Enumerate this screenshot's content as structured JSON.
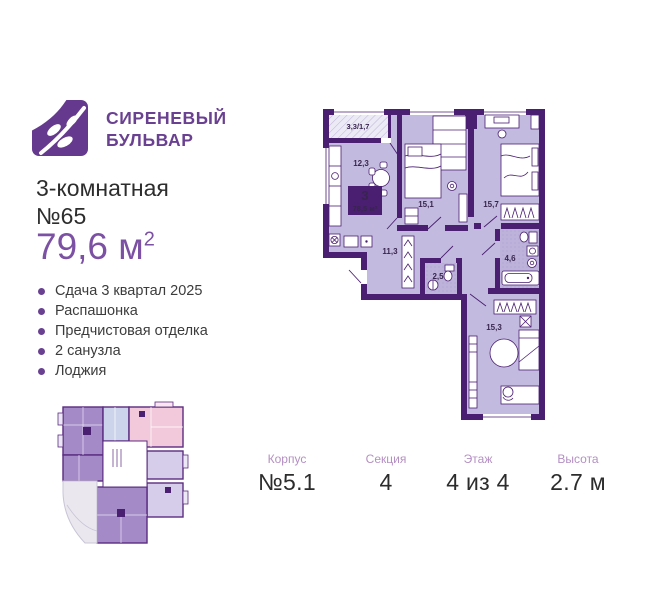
{
  "brand": {
    "line1": "СИРЕНЕВЫЙ",
    "line2": "БУЛЬВАР"
  },
  "listing": {
    "type_line": "3-комнатная",
    "number_line": "№65",
    "area_value": "79,6 м",
    "area_sup": "2"
  },
  "features": [
    "Сдача 3 квартал 2025",
    "Распашонка",
    "Предчистовая отделка",
    "2 санузла",
    "Лоджия"
  ],
  "floor_plan": {
    "badge": {
      "rooms": "3",
      "area": "78,5 м²"
    },
    "labels": {
      "balcony": "3,3/1,7",
      "kitchen": "12,3",
      "bedroom_left": "15,1",
      "bedroom_right": "15,7",
      "hallway": "11,3",
      "wc": "2,5",
      "bathroom": "4,6",
      "living": "15,3"
    }
  },
  "footer": {
    "columns": [
      {
        "label": "Корпус",
        "value": "№5.1"
      },
      {
        "label": "Секция",
        "value": "4"
      },
      {
        "label": "Этаж",
        "value": "4 из 4"
      },
      {
        "label": "Высота",
        "value": "2.7 м"
      }
    ]
  },
  "colors": {
    "brand_purple": "#6a4191",
    "area_purple": "#7c51a4",
    "wall_purple": "#4a1e71",
    "room_fill": "#c3bbdf",
    "highlight_fill": "#a48bc8",
    "pink_fill": "#f2c9da",
    "blue_fill": "#ccd4ec",
    "footer_label": "#b48fc2"
  }
}
